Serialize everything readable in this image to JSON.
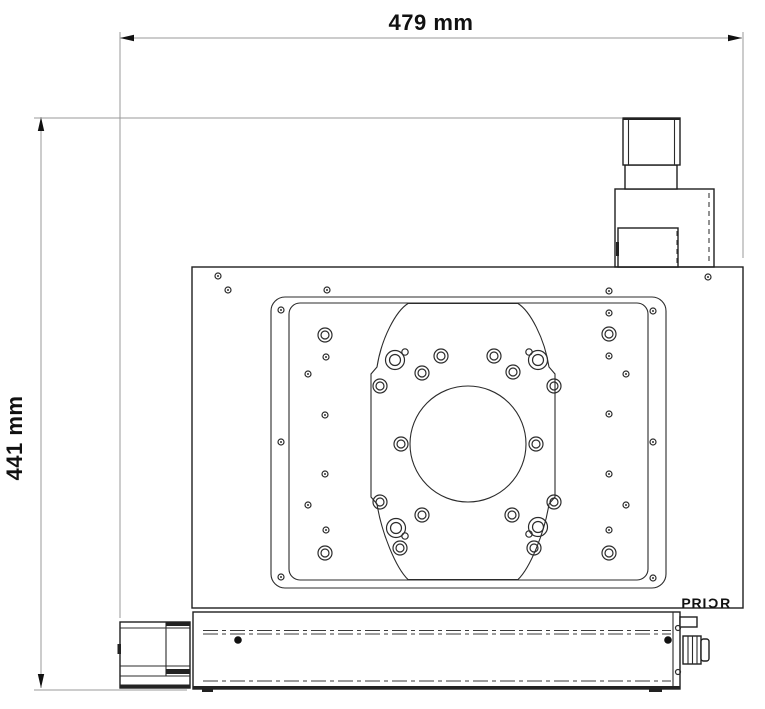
{
  "page": {
    "title": "Stage outline drawing",
    "background": "#ffffff",
    "line_color": "#1f1f1f",
    "dim_line_color": "#9a9a9a"
  },
  "dimensions": {
    "width_label": "479 mm",
    "height_label": "441 mm"
  },
  "logo": {
    "text": "PRIOR",
    "prefix": "PRI",
    "o_glyph": "Ɔ",
    "suffix": "R"
  },
  "holes": {
    "insert_rings_std": [
      [
        422,
        373
      ],
      [
        441,
        356
      ],
      [
        494,
        356
      ],
      [
        513,
        372
      ],
      [
        380,
        386
      ],
      [
        554,
        386
      ],
      [
        401,
        444
      ],
      [
        536,
        444
      ],
      [
        380,
        502
      ],
      [
        554,
        502
      ],
      [
        422,
        515
      ],
      [
        512,
        515
      ],
      [
        400,
        548
      ],
      [
        534,
        548
      ]
    ],
    "insert_rings_big": [
      [
        395,
        360
      ],
      [
        538,
        360
      ],
      [
        396,
        528
      ],
      [
        538,
        527
      ]
    ],
    "insert_dots": [
      [
        405,
        352
      ],
      [
        529,
        352
      ],
      [
        405,
        536
      ],
      [
        529,
        534
      ]
    ],
    "plate2_rings": [
      [
        325,
        335
      ],
      [
        325,
        553
      ],
      [
        609,
        334
      ],
      [
        609,
        553
      ]
    ],
    "plate2_small": [
      [
        326,
        357
      ],
      [
        308,
        374
      ],
      [
        325,
        415
      ],
      [
        325,
        474
      ],
      [
        308,
        505
      ],
      [
        326,
        530
      ],
      [
        609,
        313
      ],
      [
        609,
        356
      ],
      [
        609,
        414
      ],
      [
        609,
        474
      ],
      [
        626,
        374
      ],
      [
        626,
        505
      ],
      [
        609,
        530
      ]
    ],
    "plate1_small": [
      [
        281,
        310
      ],
      [
        281,
        442
      ],
      [
        281,
        577
      ],
      [
        653,
        311
      ],
      [
        653,
        442
      ],
      [
        653,
        578
      ]
    ],
    "body_small": [
      [
        218,
        276
      ],
      [
        228,
        290
      ],
      [
        708,
        277
      ],
      [
        327,
        290
      ],
      [
        609,
        291
      ]
    ],
    "base_small": [
      [
        678,
        628
      ],
      [
        678,
        672
      ]
    ],
    "base_black_screws": [
      [
        238,
        640
      ],
      [
        668,
        640
      ]
    ]
  }
}
